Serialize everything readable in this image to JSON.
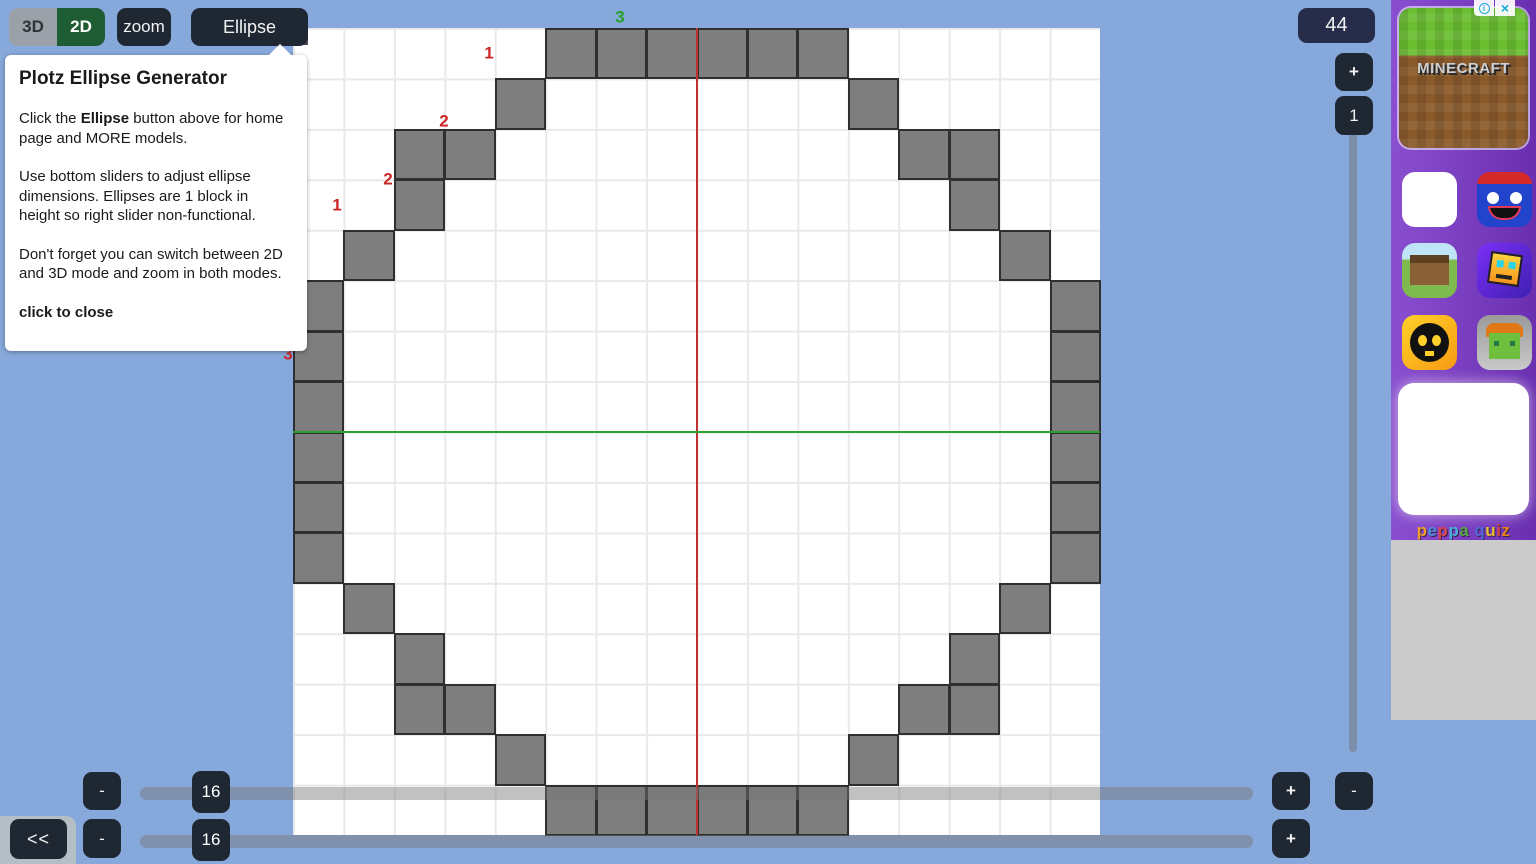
{
  "toolbar": {
    "mode_3d": "3D",
    "mode_2d": "2D",
    "zoom": "zoom",
    "ellipse": "Ellipse"
  },
  "callout": {
    "title": "Plotz Ellipse Generator",
    "p1_prefix": "Click the ",
    "p1_bold": "Ellipse",
    "p1_suffix": " button above for home page and MORE models.",
    "p2": "Use bottom sliders to adjust ellipse dimensions. Ellipses are 1 block in height so right slider non-functional.",
    "p3": "Don't forget you can switch between 2D and 3D mode and zoom in both modes.",
    "close_label": "click to close"
  },
  "controls": {
    "block_count": "44",
    "zoom_in": "+",
    "height_value": "1",
    "height_minus": "-",
    "width_minus": "-",
    "width_value": "16",
    "width_plus": "+",
    "depth_minus": "-",
    "depth_value": "16",
    "depth_plus": "+",
    "back": "<<"
  },
  "grid": {
    "cols": 16,
    "rows": 16,
    "total_blocks": 44,
    "block_color": "#7e7e7e",
    "block_border": "#2f2f2f",
    "center_line_red": "#c03232",
    "center_line_green": "#2ca02c",
    "blocks": [
      [
        5,
        0
      ],
      [
        6,
        0
      ],
      [
        7,
        0
      ],
      [
        8,
        0
      ],
      [
        9,
        0
      ],
      [
        10,
        0
      ],
      [
        4,
        1
      ],
      [
        11,
        1
      ],
      [
        2,
        2
      ],
      [
        3,
        2
      ],
      [
        12,
        2
      ],
      [
        13,
        2
      ],
      [
        2,
        3
      ],
      [
        13,
        3
      ],
      [
        1,
        4
      ],
      [
        14,
        4
      ],
      [
        0,
        5
      ],
      [
        15,
        5
      ],
      [
        0,
        6
      ],
      [
        15,
        6
      ],
      [
        0,
        7
      ],
      [
        15,
        7
      ],
      [
        0,
        8
      ],
      [
        15,
        8
      ],
      [
        0,
        9
      ],
      [
        15,
        9
      ],
      [
        0,
        10
      ],
      [
        15,
        10
      ],
      [
        1,
        11
      ],
      [
        14,
        11
      ],
      [
        2,
        12
      ],
      [
        13,
        12
      ],
      [
        2,
        13
      ],
      [
        3,
        13
      ],
      [
        12,
        13
      ],
      [
        13,
        13
      ],
      [
        4,
        14
      ],
      [
        11,
        14
      ],
      [
        5,
        15
      ],
      [
        6,
        15
      ],
      [
        7,
        15
      ],
      [
        8,
        15
      ],
      [
        9,
        15
      ],
      [
        10,
        15
      ]
    ],
    "run_labels": [
      {
        "text": "3",
        "color": "#27a127",
        "x": 620,
        "y": 17
      },
      {
        "text": "1",
        "color": "#cc2626",
        "x": 489,
        "y": 53
      },
      {
        "text": "2",
        "color": "#cc2626",
        "x": 444,
        "y": 121
      },
      {
        "text": "2",
        "color": "#cc2626",
        "x": 388,
        "y": 179
      },
      {
        "text": "1",
        "color": "#cc2626",
        "x": 337,
        "y": 205
      },
      {
        "text": "3",
        "color": "#cc2626",
        "x": 288,
        "y": 354
      }
    ]
  },
  "ad": {
    "info_icon": "i",
    "close_icon": "×",
    "logo_text": "MINECRAFT",
    "footer_text": "peppa quiz",
    "footer_letters": [
      {
        "ch": "p",
        "color": "#f0a024"
      },
      {
        "ch": "e",
        "color": "#4a90d9"
      },
      {
        "ch": "p",
        "color": "#d84848"
      },
      {
        "ch": "p",
        "color": "#48b0d8"
      },
      {
        "ch": "a",
        "color": "#55aa44"
      },
      {
        "ch": " ",
        "color": "#ffffff"
      },
      {
        "ch": "q",
        "color": "#5068d8"
      },
      {
        "ch": "u",
        "color": "#e8c030"
      },
      {
        "ch": "i",
        "color": "#d84848"
      },
      {
        "ch": "z",
        "color": "#e88020"
      }
    ],
    "icons": [
      "blank-tile",
      "huggy-wuggy",
      "minecraft-house",
      "geometry-dash",
      "brawl-stars",
      "zombie-miner"
    ]
  },
  "theme": {
    "background": "#87a8db",
    "button_dark": "#1f2733",
    "badge_navy": "#272c4a",
    "mode_green": "#1e5c34",
    "mode_gray": "#9aa1a8"
  }
}
